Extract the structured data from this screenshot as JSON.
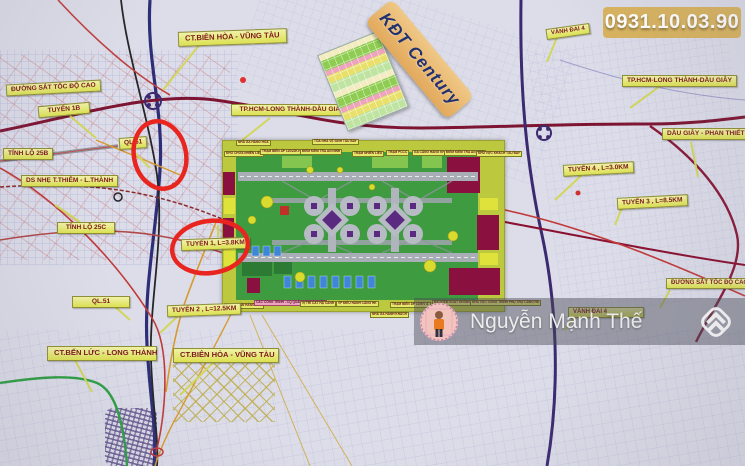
{
  "phone_plate": {
    "number": "0931.10.03.90"
  },
  "ribbon": {
    "label": "KĐT Century"
  },
  "watermark": {
    "name": "Nguyễn Mạnh Thế"
  },
  "icons": {
    "watermark_logo": "double-chevron-diamond-logo",
    "avatar": "agent-profile-photo"
  },
  "colors": {
    "map_background": "#dcdde8",
    "label_yellow": "#dce151",
    "label_text_maroon": "#7d1820",
    "red_marker": "#e8251f",
    "phone_plate_gold": "#d9b45f",
    "ribbon_orange": "#e2a95c",
    "expressway_maroon": "#7d1432",
    "ring_road_purple": "#3c2a70",
    "airport_field_green": "#3e9b40"
  },
  "road_labels": [
    "CT.BIÊN HÒA - VŨNG TÀU",
    "ĐƯỜNG SẮT TỐC ĐỘ CAO",
    "TUYẾN 1B",
    "QL.51",
    "TỈNH LỘ 25B",
    "DS NHẸ T.THIÊM - L.THÀNH",
    "TỈNH LỘ 25C",
    "TP.HCM-LONG THÀNH-DẦU GIÂY",
    "VÀNH ĐAI 4",
    "TP.HCM-LONG THÀNH-DẦU GIÂY",
    "DẦU GIÂY - PHAN THIẾT",
    "TUYẾN 4 , L=3.0KM",
    "TUYẾN 3 , L=8.5KM",
    "ĐƯỜNG SẮT TỐC ĐỘ CAO",
    "VÀNH ĐAI 4",
    "TUYẾN 1, L=3.8KM",
    "QL.51",
    "TUYẾN 2 , L=12.5KM",
    "CT.BẾN LỨC - LONG THÀNH",
    "CT.BIÊN HÒA - VŨNG TÀU"
  ],
  "plan": {
    "top_caption_left": "NHÀ GA HÀNG HÓA",
    "top_caption_right": "TÒA NHÀ VỆ SINH TÀU BAY",
    "top_row": [
      "KHO CHỨA NHIÊN LIỆU",
      "TRẠM BIẾN ÁP 110/22KV",
      "ĐIỂM KIỂM TRA AN NINH",
      "TRẠM NHIÊN LIỆU",
      "TRẠM PCCC",
      "GA CẢNG HÀNG KHÔNG",
      "ĐIỂM KIỂM TRA AN NINH",
      "KHU VỰC KHÁCH TÀU BAY"
    ],
    "bottom_row": [
      "GIAO NHẬN HÀNG HÓA",
      "CÁC CÔNG TRÌNH - CQ QUẢN LÝ NHÀ NƯỚC",
      "VỊ TRÍ CẤT HẠ CÁNH",
      "VP ĐIỀU HÀNH CẢNG HK",
      "TRẠM BIẾN ÁP 110KV A",
      "ĐÀI KIỂM SOÁT KHÔNG LƯU",
      "KHU VỰC CÔNG TRÌNH PHỤ TRỢ CẢNG HK"
    ],
    "bottom_caption": "NHÀ GA HÀNH KHÁCH"
  }
}
